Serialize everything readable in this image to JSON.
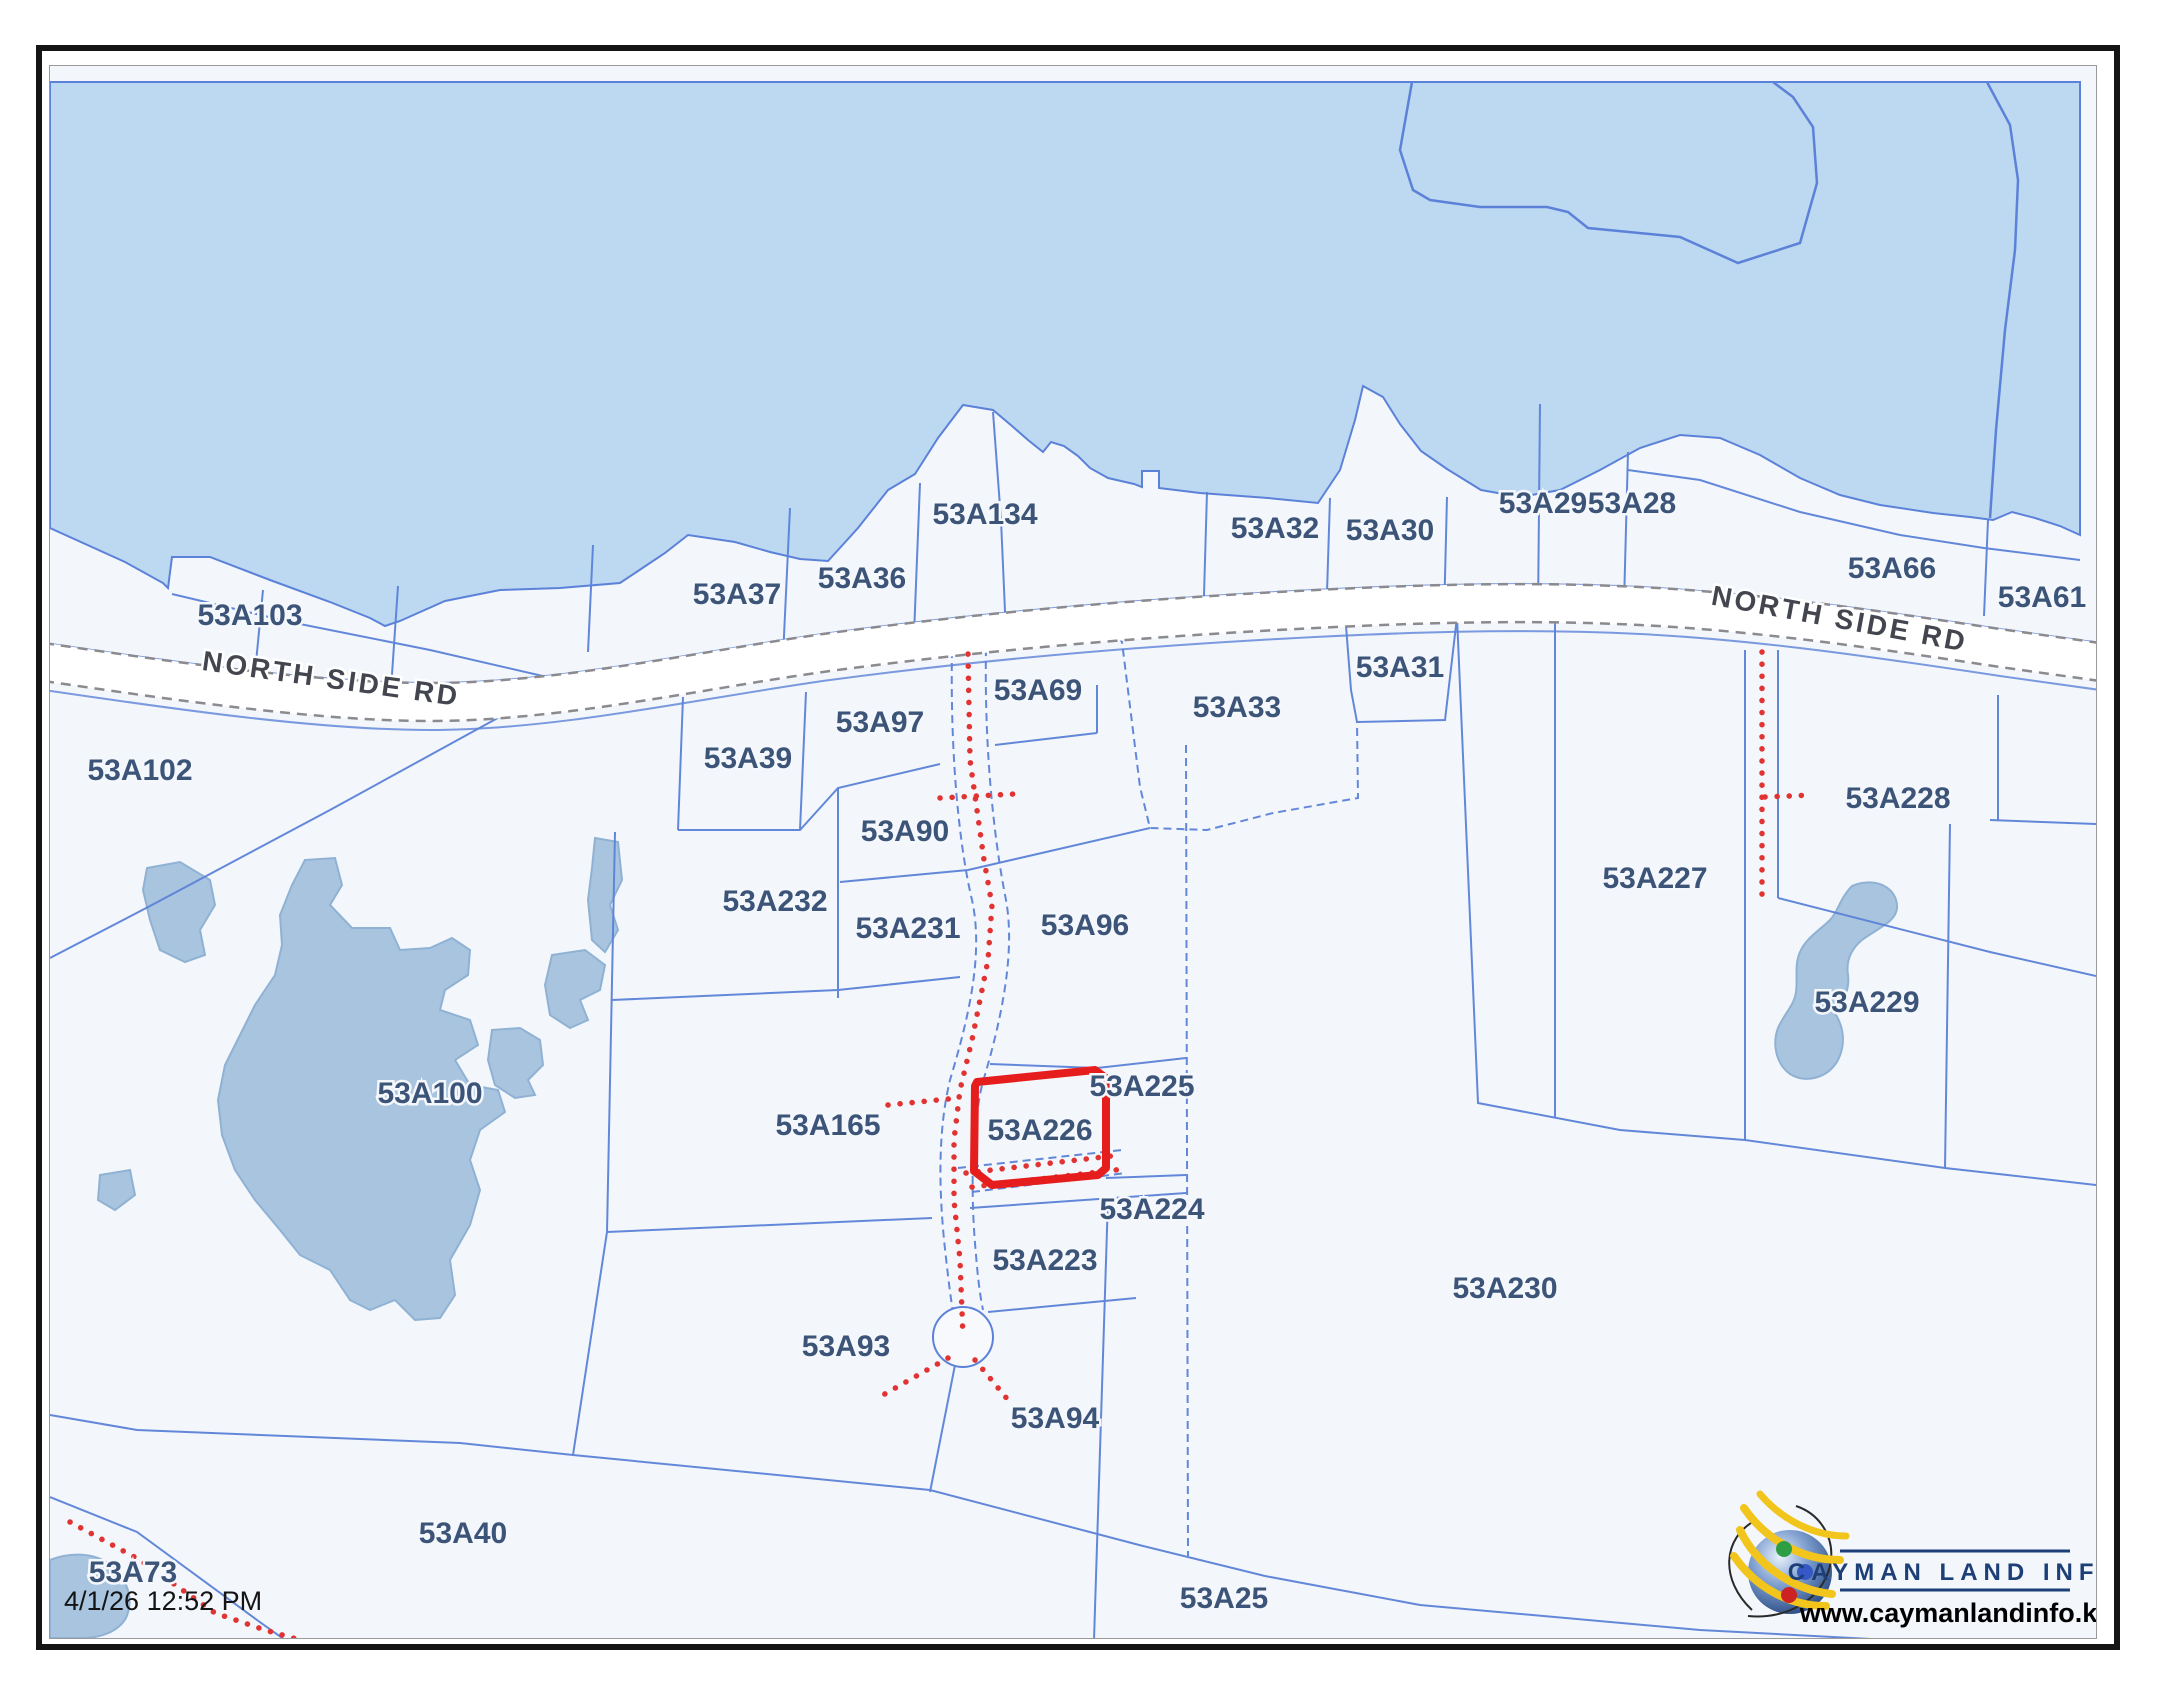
{
  "map": {
    "road_label_left": "NORTH SIDE RD",
    "road_label_right": "NORTH SIDE RD",
    "timestamp": "4/1/26 12:52 PM",
    "highlighted_parcel_id": "53A226",
    "parcels": {
      "a103": "53A103",
      "a102": "53A102",
      "a100": "53A100",
      "a37": "53A37",
      "a36": "53A36",
      "a134": "53A134",
      "a32": "53A32",
      "a30": "53A30",
      "a29": "53A29",
      "a28": "53A28",
      "a66": "53A66",
      "a61": "53A61",
      "a97": "53A97",
      "a69": "53A69",
      "a33": "53A33",
      "a31": "53A31",
      "a39": "53A39",
      "a90": "53A90",
      "a232": "53A232",
      "a231": "53A231",
      "a96": "53A96",
      "a228": "53A228",
      "a227": "53A227",
      "a229": "53A229",
      "a165": "53A165",
      "a226": "53A226",
      "a225": "53A225",
      "a224": "53A224",
      "a223": "53A223",
      "a93": "53A93",
      "a94": "53A94",
      "a230": "53A230",
      "a40": "53A40",
      "a73": "53A73",
      "a25": "53A25"
    }
  },
  "branding": {
    "org": "CAYMAN LAND INFO",
    "website": "www.caymanlandinfo.ky",
    "logo_icon": "globe-icon"
  },
  "colors": {
    "water": "#bdd8f1",
    "pond": "#a9c4de",
    "land": "#f3f6fb",
    "boundary_line": "#5b82d8",
    "parcel_label": "#3c5478",
    "road_casing": "#8a8a8f",
    "highlight_outline": "#e51d1d",
    "survey_dots": "#e23333",
    "brand_navy": "#1d3f77"
  }
}
